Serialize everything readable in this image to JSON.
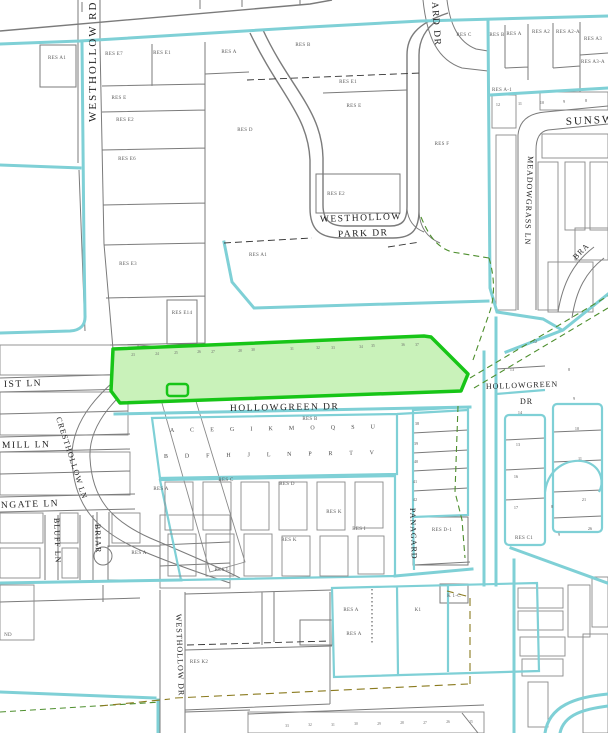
{
  "map": {
    "type": "parcel-plat-map",
    "colors": {
      "boundary_cyan": "#7fd0d6",
      "parcel_gray": "#7b7b7b",
      "highlight_green_border": "#17c517",
      "highlight_green_fill": "#c9f2ba",
      "dash_green": "#4e8f2e",
      "dash_olive": "#8a7a1e",
      "label_text": "#3a3a3a",
      "background": "#ffffff"
    },
    "streets": [
      {
        "id": "westhollow-rd",
        "label": "WESTHOLLOW RD"
      },
      {
        "id": "ard-dr",
        "label": "ARD DR"
      },
      {
        "id": "westhollow-park-dr-line1",
        "label": "WESTHOLLOW"
      },
      {
        "id": "westhollow-park-dr-line2",
        "label": "PARK DR"
      },
      {
        "id": "hollowgreen-dr",
        "label": "HOLLOWGREEN DR"
      },
      {
        "id": "hollowgreen-dr-right-line1",
        "label": "HOLLOWGREEN"
      },
      {
        "id": "hollowgreen-dr-right-line2",
        "label": "DR"
      },
      {
        "id": "sunswept",
        "label": "SUNSW"
      },
      {
        "id": "meadowgrass-ln",
        "label": "MEADOWGRASS LN"
      },
      {
        "id": "braes",
        "label": "BRA"
      },
      {
        "id": "cresthollow-ln",
        "label": "CRESTHOLLOW LN"
      },
      {
        "id": "ist-ln",
        "label": "IST LN"
      },
      {
        "id": "mill-ln",
        "label": "MILL LN"
      },
      {
        "id": "ngate-ln",
        "label": "NGATE LN"
      },
      {
        "id": "bluff-ln",
        "label": "BLUFF LN"
      },
      {
        "id": "briar",
        "label": "BRIAR"
      },
      {
        "id": "panagard",
        "label": "PANAGARD"
      },
      {
        "id": "westhollow-dr",
        "label": "WESTHOLLOW DR"
      }
    ],
    "parcels": [
      {
        "label": "RES A1"
      },
      {
        "label": "RES E7"
      },
      {
        "label": "RES E1"
      },
      {
        "label": "RES E"
      },
      {
        "label": "RES E2"
      },
      {
        "label": "RES E6"
      },
      {
        "label": "RES E3"
      },
      {
        "label": "RES E14"
      },
      {
        "label": "RES A"
      },
      {
        "label": "RES B"
      },
      {
        "label": "RES E1"
      },
      {
        "label": "RES E"
      },
      {
        "label": "RES D"
      },
      {
        "label": "RES E2"
      },
      {
        "label": "RES F"
      },
      {
        "label": "RES C"
      },
      {
        "label": "RES A1"
      },
      {
        "label": "RES B"
      },
      {
        "label": "RES A"
      },
      {
        "label": "RES A2"
      },
      {
        "label": "RES A2-A"
      },
      {
        "label": "RES A3"
      },
      {
        "label": "RES A3-A"
      },
      {
        "label": "RES A-1"
      },
      {
        "label": "RES B"
      },
      {
        "label": "RES A"
      },
      {
        "label": "RES C"
      },
      {
        "label": "RES D"
      },
      {
        "label": "RES K"
      },
      {
        "label": "RES K"
      },
      {
        "label": "RES I"
      },
      {
        "label": "RES L"
      },
      {
        "label": "RES A"
      },
      {
        "label": "RES D-1"
      },
      {
        "label": "RES C1"
      },
      {
        "label": "RES A"
      },
      {
        "label": "RES A"
      },
      {
        "label": "K1"
      },
      {
        "label": "RES K2"
      },
      {
        "label": "K 1-C"
      },
      {
        "label": "ND"
      }
    ],
    "highlighted_parcel": {
      "description": "green highlighted parcel along Hollowgreen Dr",
      "lot_numbers": [
        "23",
        "24",
        "25",
        "26",
        "27",
        "28",
        "30",
        "31",
        "32",
        "33",
        "34",
        "35",
        "36",
        "37"
      ]
    },
    "lot_numbers": {
      "panagard_column": [
        "38",
        "39",
        "40",
        "41",
        "42"
      ],
      "block_a": [
        "14",
        "13",
        "16",
        "17"
      ],
      "block_b": [
        "10",
        "11",
        "21",
        "26",
        "8",
        "9"
      ],
      "hollowgreen_area": [
        "12",
        "13",
        "8",
        "9"
      ],
      "sunswept_row": [
        "12",
        "11",
        "10",
        "9",
        "8"
      ],
      "bottom_row": [
        "33",
        "32",
        "31",
        "30",
        "29",
        "28",
        "27",
        "26",
        "25"
      ]
    },
    "block_letters": {
      "row1": "A C E G I K M O Q S U",
      "row2": "B D F H J L N P R T V"
    }
  }
}
